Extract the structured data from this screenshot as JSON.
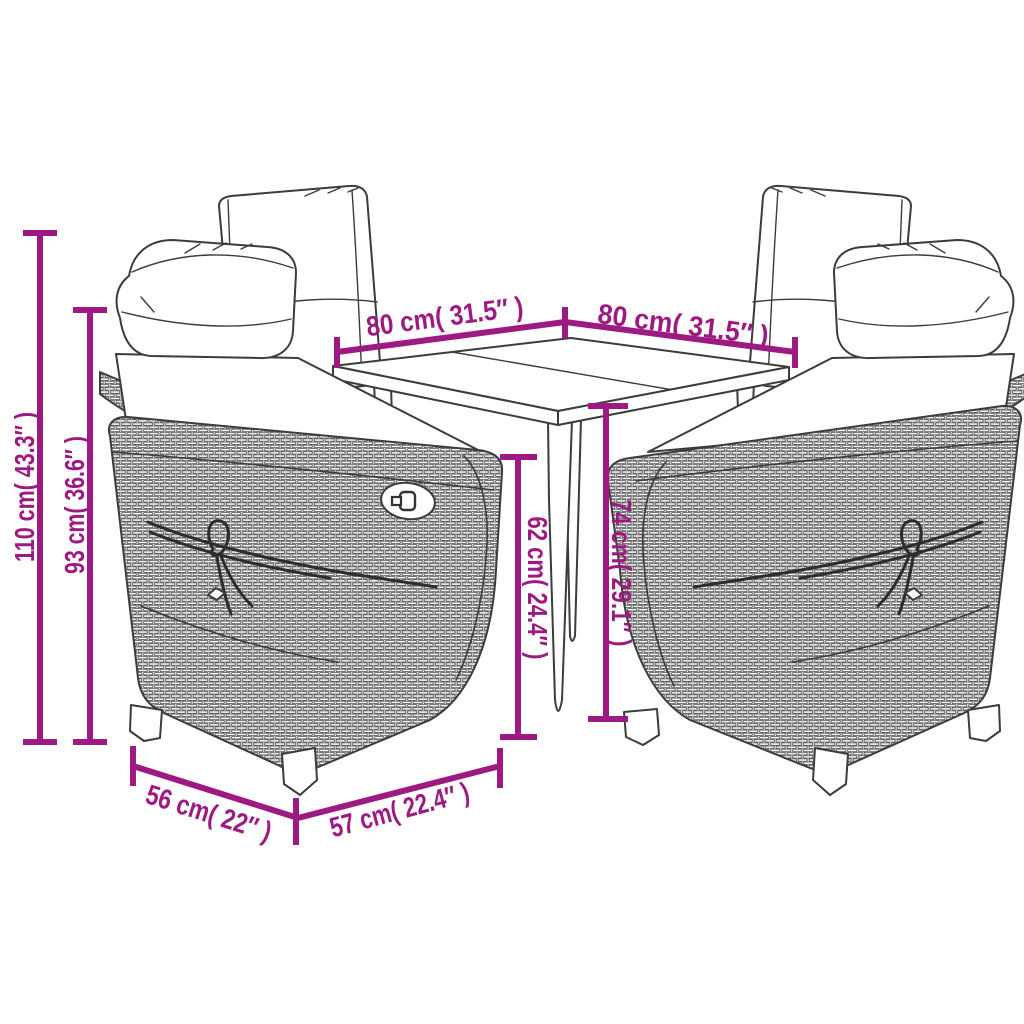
{
  "title": "Garden furniture set dimension diagram",
  "colors": {
    "dimension": "#9c1a82",
    "line_art": "#3c3c3c",
    "background": "#ffffff"
  },
  "scene": {
    "items": [
      "reclining-wicker-chair-back-left",
      "reclining-wicker-chair-back-right",
      "square-dining-table",
      "reclining-wicker-chair-front-left",
      "reclining-wicker-chair-front-right"
    ]
  },
  "dims": {
    "d110": {
      "label": "110 cm( 43.3″ )",
      "meaning": "chair total height"
    },
    "d93": {
      "label": "93 cm( 36.6″ )",
      "meaning": "chair backrest height"
    },
    "d80l": {
      "label": "80 cm( 31.5″ )",
      "meaning": "tabletop side"
    },
    "d80r": {
      "label": "80 cm( 31.5″ )",
      "meaning": "tabletop side"
    },
    "d62": {
      "label": "62 cm( 24.4″ )",
      "meaning": "height under table"
    },
    "d74": {
      "label": "74 cm( 29.1″ )",
      "meaning": "table height"
    },
    "d56": {
      "label": "56 cm( 22″ )",
      "meaning": "chair width"
    },
    "d57": {
      "label": "57 cm( 22.4″ )",
      "meaning": "chair depth"
    }
  }
}
